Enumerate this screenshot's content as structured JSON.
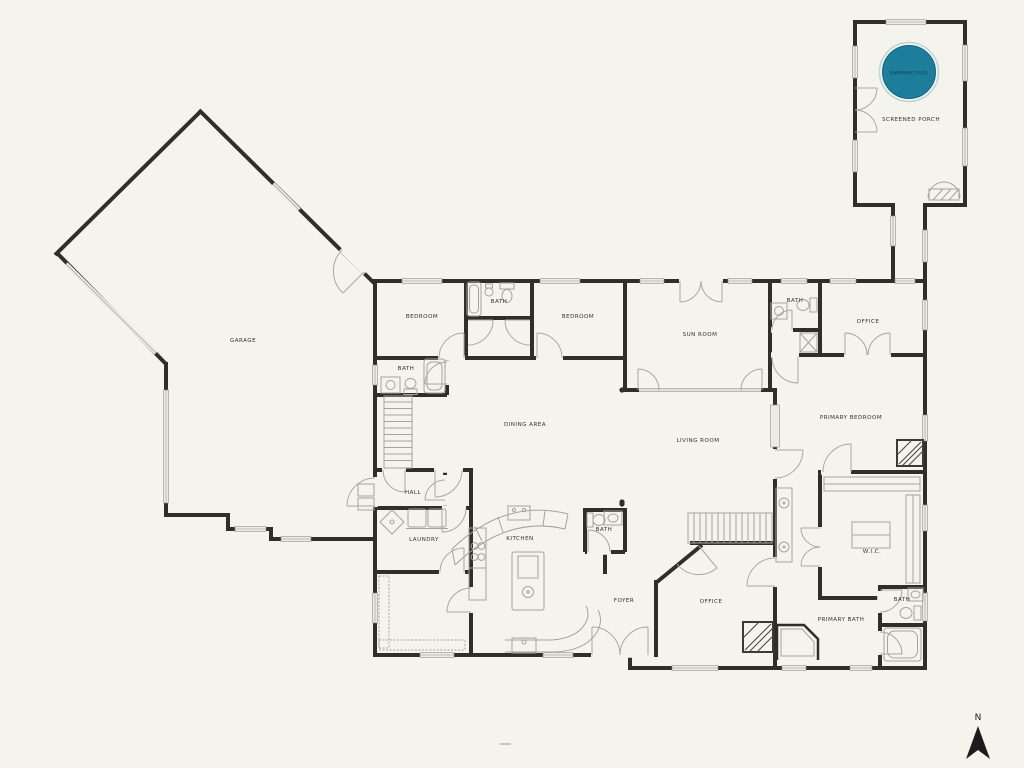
{
  "title": "Single-story house floor plan with screened porch and pool",
  "colors": {
    "background": "#f5f4ec",
    "wall": "#2f2e2b",
    "fixture_line": "#a5a49b",
    "window_fill": "#ecebe2",
    "label_text": "#34332f",
    "pool_fill": "#1d7e9b",
    "pool_ring": "#b7d6dd",
    "pool_label_text": "#0a3d4b",
    "compass": "#1c1c1a"
  },
  "rooms": [
    {
      "id": "garage",
      "label": "GARAGE"
    },
    {
      "id": "bedroom-1",
      "label": "BEDROOM"
    },
    {
      "id": "jack-and-jill-bath",
      "label": "BATH"
    },
    {
      "id": "bedroom-2",
      "label": "BEDROOM"
    },
    {
      "id": "sun-room",
      "label": "SUN ROOM"
    },
    {
      "id": "office-top-bath",
      "label": "BATH"
    },
    {
      "id": "office-top",
      "label": "OFFICE"
    },
    {
      "id": "hall-bath",
      "label": "BATH"
    },
    {
      "id": "dining-area",
      "label": "DINING AREA"
    },
    {
      "id": "living-room",
      "label": "LIVING ROOM"
    },
    {
      "id": "primary-bedroom",
      "label": "PRIMARY BEDROOM"
    },
    {
      "id": "hall",
      "label": "HALL"
    },
    {
      "id": "laundry",
      "label": "LAUNDRY"
    },
    {
      "id": "kitchen",
      "label": "KITCHEN"
    },
    {
      "id": "powder-bath",
      "label": "BATH"
    },
    {
      "id": "foyer",
      "label": "FOYER"
    },
    {
      "id": "office-bottom",
      "label": "OFFICE"
    },
    {
      "id": "walk-in-closet",
      "label": "W.I.C."
    },
    {
      "id": "primary-small-bath",
      "label": "BATH"
    },
    {
      "id": "primary-bath",
      "label": "PRIMARY BATH"
    },
    {
      "id": "screened-porch",
      "label": "SCREENED PORCH"
    }
  ],
  "pool": {
    "label": "SWIMMING POOL"
  },
  "compass": {
    "label": "N"
  }
}
